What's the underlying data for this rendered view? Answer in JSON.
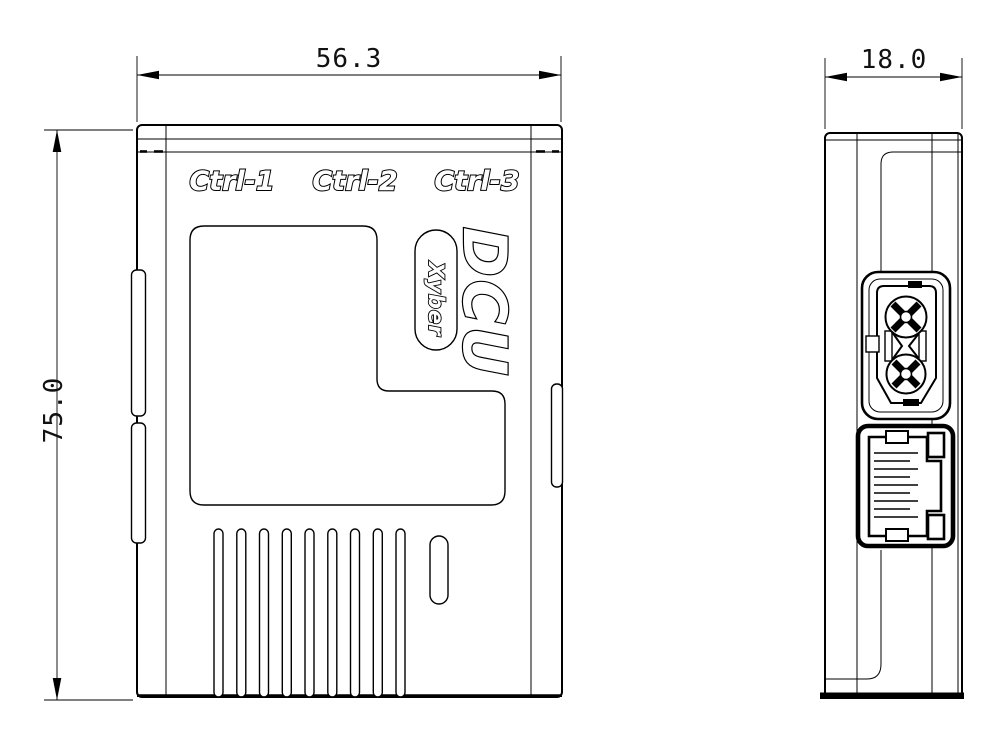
{
  "colors": {
    "line": "#000000",
    "background": "#ffffff"
  },
  "front_view": {
    "port_labels": [
      "Ctrl-1",
      "Ctrl-2",
      "Ctrl-3"
    ],
    "product_name": "DCU",
    "brand": "Xyber",
    "width_dim": "56.3",
    "height_dim": "75.0"
  },
  "side_view": {
    "depth_dim": "18.0"
  }
}
